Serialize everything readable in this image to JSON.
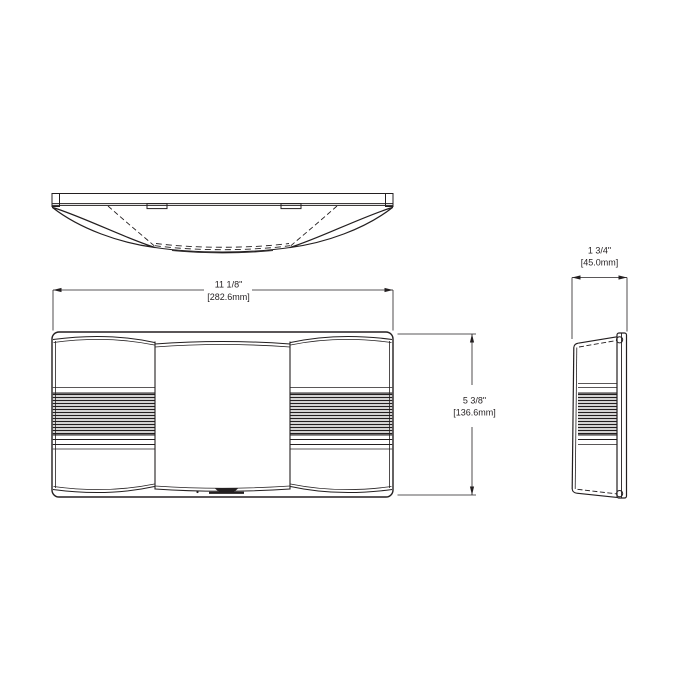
{
  "page": {
    "background": "#ffffff",
    "line_color": "#231f20"
  },
  "dimensions": {
    "width": {
      "imperial": "11 1/8\"",
      "metric": "[282.6mm]"
    },
    "height": {
      "imperial": "5 3/8\"",
      "metric": "[136.6mm]"
    },
    "depth": {
      "imperial": "1 3/4\"",
      "metric": "[45.0mm]"
    }
  }
}
